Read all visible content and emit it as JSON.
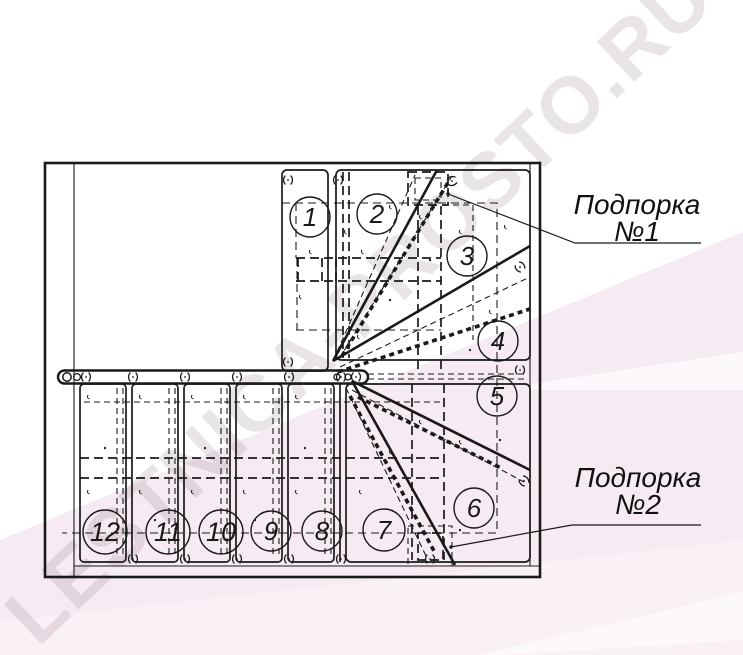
{
  "watermark": {
    "text": "LESTNICA-PROSTO.RU"
  },
  "labels": {
    "support1_line1": "Подпорка",
    "support1_line2": "№1",
    "support2_line1": "Подпорка",
    "support2_line2": "№2"
  },
  "steps": [
    {
      "label": "1"
    },
    {
      "label": "2"
    },
    {
      "label": "3"
    },
    {
      "label": "4"
    },
    {
      "label": "5"
    },
    {
      "label": "6"
    },
    {
      "label": "7"
    },
    {
      "label": "8"
    },
    {
      "label": "9"
    },
    {
      "label": "10"
    },
    {
      "label": "11"
    },
    {
      "label": "12"
    }
  ],
  "colors": {
    "line": "#1a1a1a",
    "background": "#ffffff",
    "pink_main": "#f7ebf3",
    "pink_light": "#faf1f7",
    "watermark_tint": "#8f7a88"
  }
}
